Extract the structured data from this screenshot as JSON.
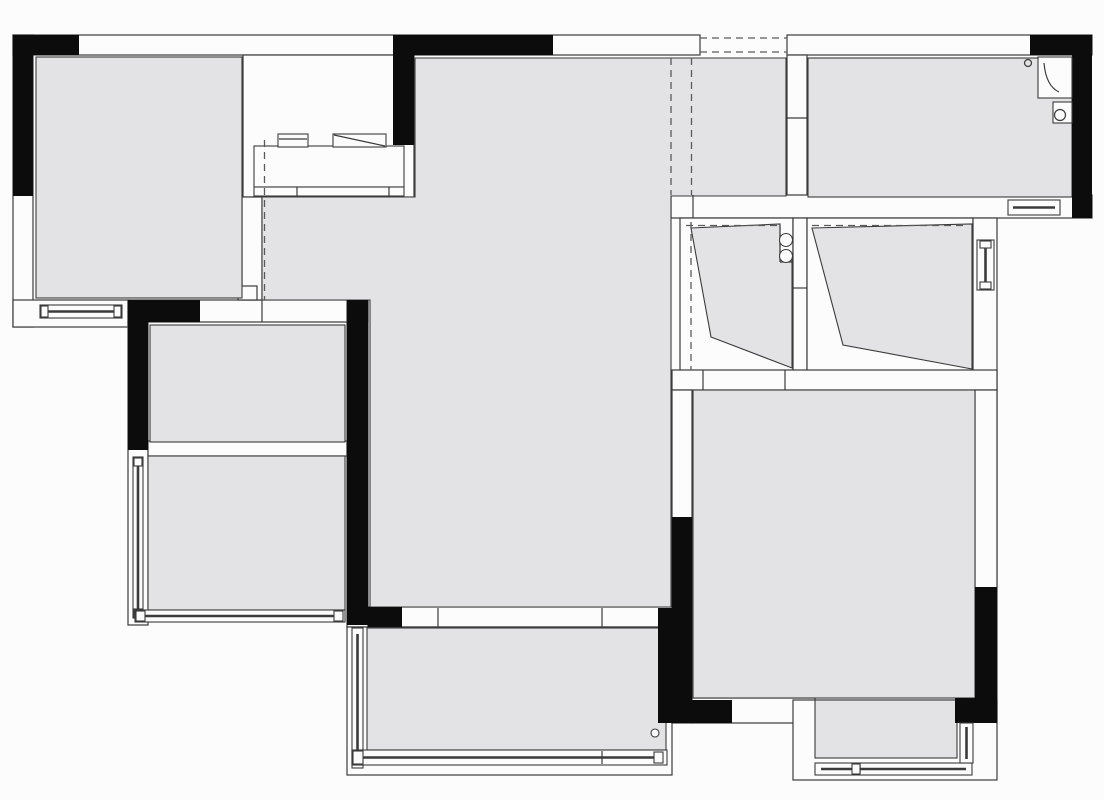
{
  "meta": {
    "title": "apartment-floor-plan",
    "canvas_width": 1104,
    "canvas_height": 800,
    "drawing_type": "architectural floor plan, top view, no text labels"
  },
  "colors": {
    "paper": "#fcfcfd",
    "room_fill": "#e3e3e5",
    "line": "#3b3b3b",
    "dash": "#5a5a5a",
    "wall_black": "#0c0c0c"
  },
  "rooms": [
    {
      "id": "room-top-left",
      "kind": "bedroom"
    },
    {
      "id": "room-central-living-dining-entry",
      "kind": "living-dining-kitchen"
    },
    {
      "id": "room-top-right",
      "kind": "bathroom"
    },
    {
      "id": "room-left-middle-upper",
      "kind": "small-room"
    },
    {
      "id": "room-left-middle-lower",
      "kind": "bay-room-with-windows"
    },
    {
      "id": "wardrobe-left-compartment",
      "kind": "closet"
    },
    {
      "id": "wardrobe-right-compartment",
      "kind": "closet"
    },
    {
      "id": "room-bottom-right",
      "kind": "master-bedroom"
    },
    {
      "id": "balcony-bottom-center",
      "kind": "balcony"
    },
    {
      "id": "balcony-bottom-right",
      "kind": "balcony"
    }
  ],
  "fixtures": [
    {
      "icon": "kitchen-cooktop-icon"
    },
    {
      "icon": "kitchen-sink-drainer-icon"
    },
    {
      "icon": "kitchen-counter"
    },
    {
      "icon": "corner-shower-icon"
    },
    {
      "icon": "toilet-icon"
    },
    {
      "icon": "floor-drain-icon-bath"
    },
    {
      "icon": "floor-drain-icon-balcony"
    },
    {
      "icon": "pipe-duct-circles-icon"
    }
  ],
  "symbols": {
    "windows": [
      "window-bedroom-bottom",
      "window-left-room-side",
      "window-left-room-bottom",
      "window-balcony-side",
      "window-balcony-bottom",
      "window-bath-bottom",
      "window-right-wall",
      "window-balcony-right-bottom",
      "window-balcony-right-side"
    ],
    "dashed_openings": [
      "entry-opening-top",
      "entry-corridor-dashed-left",
      "entry-corridor-dashed-right",
      "kitchen-open-boundary-dashed",
      "wardrobe-dashed-left",
      "wardrobe-rail-dashed-left",
      "wardrobe-rail-dashed-right"
    ],
    "door_ticks": [
      "balcony-sliding-door",
      "master-bedroom-doorway",
      "left-room-doorway"
    ]
  }
}
